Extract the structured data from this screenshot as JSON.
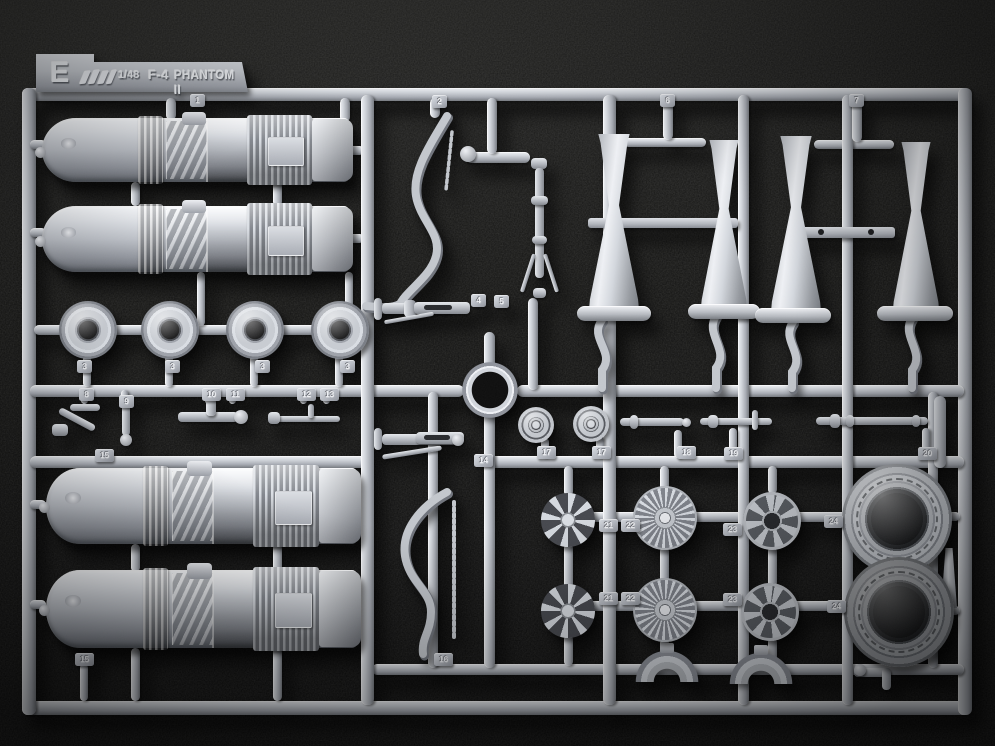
{
  "scene": {
    "description": "Overhead photo of a light-grey injection-moulded plastic sprue (runner E) from a Tamiya 1/48 scale F-4 Phantom II model kit, lying on black textured cloth",
    "plastic_color": "#c6cad0",
    "background_color": "#0c0c0b"
  },
  "label": {
    "sprue_letter": "E",
    "logo_icon": "tamiya-kanji-logo",
    "scale_text": "1/48",
    "aircraft_text": "F-4",
    "name_text": "PHANTOM II"
  },
  "tabs": [
    {
      "n": "1",
      "x": 190,
      "y": 94
    },
    {
      "n": "2",
      "x": 432,
      "y": 95
    },
    {
      "n": "6",
      "x": 660,
      "y": 94
    },
    {
      "n": "7",
      "x": 849,
      "y": 94
    },
    {
      "n": "3",
      "x": 77,
      "y": 360
    },
    {
      "n": "3",
      "x": 165,
      "y": 360
    },
    {
      "n": "3",
      "x": 255,
      "y": 360
    },
    {
      "n": "3",
      "x": 340,
      "y": 360
    },
    {
      "n": "8",
      "x": 79,
      "y": 388
    },
    {
      "n": "9",
      "x": 119,
      "y": 395
    },
    {
      "n": "10",
      "x": 202,
      "y": 388
    },
    {
      "n": "11",
      "x": 226,
      "y": 388
    },
    {
      "n": "12",
      "x": 297,
      "y": 388
    },
    {
      "n": "13",
      "x": 320,
      "y": 388
    },
    {
      "n": "15",
      "x": 95,
      "y": 449
    },
    {
      "n": "15",
      "x": 75,
      "y": 653
    },
    {
      "n": "4",
      "x": 471,
      "y": 294
    },
    {
      "n": "5",
      "x": 494,
      "y": 295
    },
    {
      "n": "14",
      "x": 474,
      "y": 454
    },
    {
      "n": "16",
      "x": 434,
      "y": 653
    },
    {
      "n": "17",
      "x": 537,
      "y": 446
    },
    {
      "n": "17",
      "x": 592,
      "y": 446
    },
    {
      "n": "18",
      "x": 677,
      "y": 446
    },
    {
      "n": "19",
      "x": 724,
      "y": 447
    },
    {
      "n": "20",
      "x": 918,
      "y": 447
    },
    {
      "n": "21",
      "x": 599,
      "y": 519
    },
    {
      "n": "22",
      "x": 621,
      "y": 519
    },
    {
      "n": "23",
      "x": 723,
      "y": 523
    },
    {
      "n": "24",
      "x": 824,
      "y": 515
    },
    {
      "n": "21",
      "x": 599,
      "y": 592
    },
    {
      "n": "22",
      "x": 621,
      "y": 592
    },
    {
      "n": "23",
      "x": 723,
      "y": 593
    },
    {
      "n": "24",
      "x": 827,
      "y": 600
    }
  ],
  "parts_inventory": [
    "turbojet engine half x4",
    "afterburner nozzle half x4",
    "main-wheel tyre x4",
    "nose wheel x2",
    "compressor fan wheel x2",
    "turbine wheel x2",
    "flame-holder ring x2",
    "engine intake ring x2",
    "landing-gear strut x3",
    "actuator rod x3",
    "curved splitter frame x2",
    "duct arc segment x2"
  ]
}
